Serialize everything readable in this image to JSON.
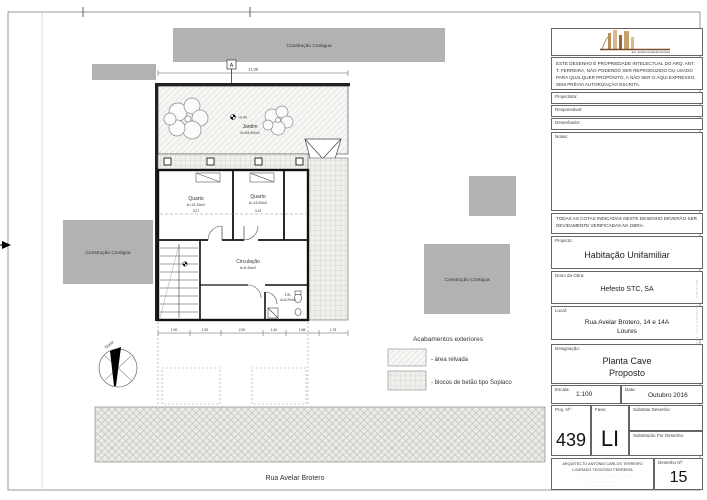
{
  "plan": {
    "adjacent_label": "Construção Contigua",
    "garden": {
      "name": "Jardim",
      "area": "A=93.90m2",
      "level": "+0.40"
    },
    "rooms": [
      {
        "name": "Quarto",
        "area": "A=13.10m2"
      },
      {
        "name": "Quarto",
        "area": "A=13.00m2"
      },
      {
        "name": "Circulação",
        "area": "A=6.40m2"
      },
      {
        "name": "I.S.",
        "area": "A=6.20m2"
      }
    ],
    "section_marker": "A",
    "north_label": "Norte",
    "dims": {
      "top_total": "11.98",
      "room_widths": [
        "3.27",
        "3.24"
      ],
      "bottom_chain": [
        "1.90",
        "1.90",
        "2.50",
        "1.40",
        "1.98",
        "1.75"
      ]
    },
    "street": "Rua Avelar Brotero",
    "legend": {
      "title": "Acabamentos exteriores",
      "item1": "- área relvada",
      "item2": "- blocos de betão tipo Soplaco"
    }
  },
  "title_block": {
    "logo_caption": "arq. antónio teodósio ferreira",
    "disclaimer": "ESTE DESENHO É PROPRIEDADE INTELECTUAL DO ARQ. ANT. T. FERREIRA, NÃO PODENDO SER REPRODUZIDO OU USADO PARA QUALQUER PROPÓSITO, A NÃO SER O AQUI EXPRESSO, SEM PRÉVIA AUTORIZAÇÃO ESCRITA.",
    "fields": {
      "projectista": "Projectista:",
      "responsavel": "Responsável:",
      "desenhador": "Desenhador:",
      "notas": "Notas:"
    },
    "cotas_note": "TODAS AS COTAS INDICADAS NESTE DESENHO DEVERÃO SER DEVIDAMENTE VERIFICADAS NA OBRA.",
    "projecto": {
      "label": "Projecto:",
      "value": "Habitação Unifamiliar"
    },
    "dono": {
      "label": "Dono da Obra:",
      "value": "Hefesto STC, SA"
    },
    "local": {
      "label": "Local:",
      "line1": "Rua Avelar Brotero, 14 e 14A",
      "line2": "Loures"
    },
    "designacao": {
      "label": "Designação:",
      "line1": "Planta Cave",
      "line2": "Proposto"
    },
    "escala": {
      "label": "Escala:",
      "value": "1:100"
    },
    "data": {
      "label": "Data:",
      "value": "Outubro 2016"
    },
    "proj_n": {
      "label": "Proj. Nº:",
      "value": "439"
    },
    "fase": {
      "label": "Fase:",
      "value": "LI"
    },
    "substitui": {
      "label": "Substitui Desenho:"
    },
    "substituido": {
      "label": "Substituído Por Desenho:"
    },
    "architect": {
      "line1": "ARQUITECTO ANTÓNIO CARLOS TERREIRO",
      "line2": "LOGRADO TEODÓSIO FERREIRA",
      "contact": "··· ····· ·· · ······· · ········ · ·····"
    },
    "desenho_n": {
      "label": "Desenho Nº:",
      "value": "15"
    }
  }
}
